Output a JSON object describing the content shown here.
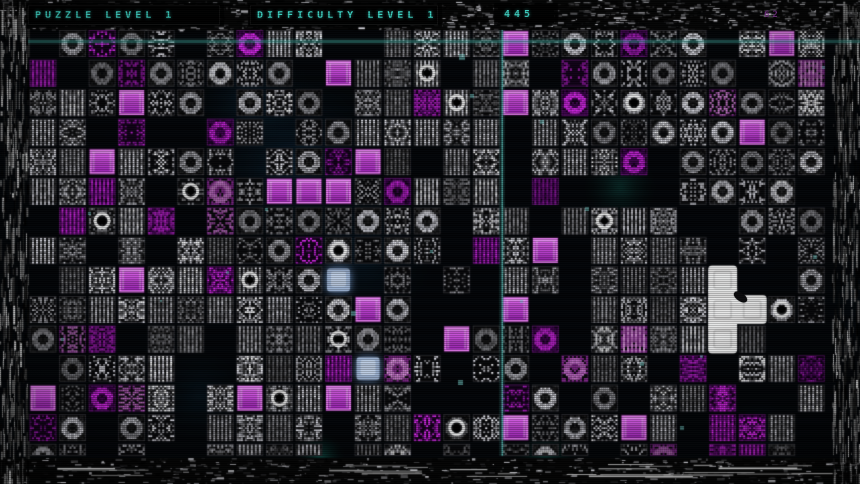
{
  "header": {
    "puzzle_label": "PUZZLE LEVEL 1",
    "difficulty_label": "DIFFICULTY LEVEL 1",
    "counter": "445",
    "aux_value": "62"
  },
  "grid": {
    "cols": 27,
    "rows": 15,
    "origin_x": 29.5,
    "origin_y": 30,
    "pitch": 29.55,
    "tile_size": 27,
    "clip_bottom": 456,
    "legend": {
      ".": "empty-dark-cell",
      "n": "monochrome-noise-tile",
      "c": "noise-tile-with-circle-glyph",
      "m": "magenta-noise-tile",
      "p": "bright-pink-noise-tile",
      "s": "solid-magenta-square-tile",
      "b": "glowing-blue-tile",
      "W": "white-cursor-cell"
    },
    "cells": [
      ".nmnn.nmnn..nnnnsnnnmnn.nsn",
      "m.nmnnnnn.snnc.nn.mnnnnn.np",
      "nnnsnn.nnn.nnmcnsnmncnnpnnn",
      "nn.m..mn.nnnnnnn.nnnnnnnsnn",
      "nnsnnnn.nnmsn.nn.nnnm.nnnnn",
      "nnmn.cpnsssnmnnn.m....nnnn.",
      ".mcnm.pnnnnnnn.nn.ncnn..nnn",
      "nn.n.nnnnmcnnn.mns.nnnn.n.n",
      ".nnsnnmcnnb.n.n.nn.nnnnW..n",
      "nnnnnnnnnnnsn...s..nnnnWWcn",
      "npm.nn.nnncnn.snnm.npnnWn..",
      ".nnnn..nnnmbpn.nn.pnn.m.nnm",
      "snmpn.nscnsnn...mn.n.nnm..n",
      "mn.nn.nnnn.nnmcnsnnnsn.mmn.",
      "nn.n..nnnn.nn.n.nnn.np.mmn."
    ]
  },
  "cursor": {
    "shape_cells": [
      [
        23,
        8
      ],
      [
        23,
        9
      ],
      [
        24,
        9
      ],
      [
        23,
        10
      ]
    ],
    "pointer_col": 23,
    "pointer_row": 9
  },
  "crosshair": {
    "horizontal_y": 41.5,
    "vertical_x": 502
  },
  "colors": {
    "accent_cyan": "#41dccc",
    "crosshair_h": "#3cbfb2",
    "crosshair_v": "#6fece4",
    "magenta_solid": "#d055e0",
    "magenta_border": "#e97ef2",
    "magenta_noise": "#b428d2",
    "pink_noise": "#f08cf0",
    "blue_tile": "#a9bede",
    "cursor_white": "#f2f2f2",
    "aux_purple": "#9a3fae",
    "background": "#030508"
  }
}
